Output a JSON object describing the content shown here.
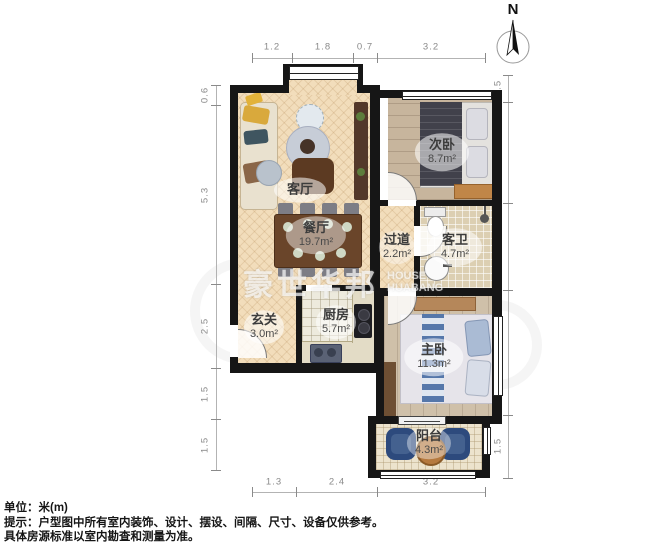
{
  "north_label": "N",
  "watermark": {
    "cn": "豪世华邦",
    "en_line1": "HOUSE",
    "en_line2": "HUABANG"
  },
  "rooms": {
    "living": {
      "name": "客厅",
      "area": ""
    },
    "dining": {
      "name": "餐厅",
      "area": "19.7m²"
    },
    "bedroom2": {
      "name": "次卧",
      "area": "8.7m²"
    },
    "hallway": {
      "name": "过道",
      "area": "2.2m²"
    },
    "bathroom": {
      "name": "客卫",
      "area": "4.7m²"
    },
    "entry": {
      "name": "玄关",
      "area": "3.0m²"
    },
    "kitchen": {
      "name": "厨房",
      "area": "5.7m²"
    },
    "master": {
      "name": "主卧",
      "area": "11.3m²"
    },
    "balcony": {
      "name": "阳台",
      "area": "4.3m²"
    }
  },
  "dims": {
    "top": [
      "1.2",
      "1.8",
      "0.7",
      "3.2"
    ],
    "bottom": [
      "1.3",
      "2.4",
      "3.2"
    ],
    "left": [
      "0.6",
      "5.3",
      "2.5",
      "1.5",
      "1.5"
    ],
    "right": [
      "0.5",
      "3.0",
      "2.5",
      "3.7",
      "1.5"
    ]
  },
  "footer": {
    "unit_line": "单位：米(m)",
    "tip_line1": "提示：户型图中所有室内装饰、设计、摆设、间隔、尺寸、设备仅供参考。",
    "tip_line2": "具体房源标准以室内勘查和测量为准。"
  },
  "colors": {
    "wall": "#161616",
    "wood_floor": "#f2ddbb",
    "tile_floor": "#dccfb2",
    "accent_blue_chair": "#2d4a7d",
    "dining_table": "#6a452a",
    "dim_text": "#8a8a8a"
  }
}
